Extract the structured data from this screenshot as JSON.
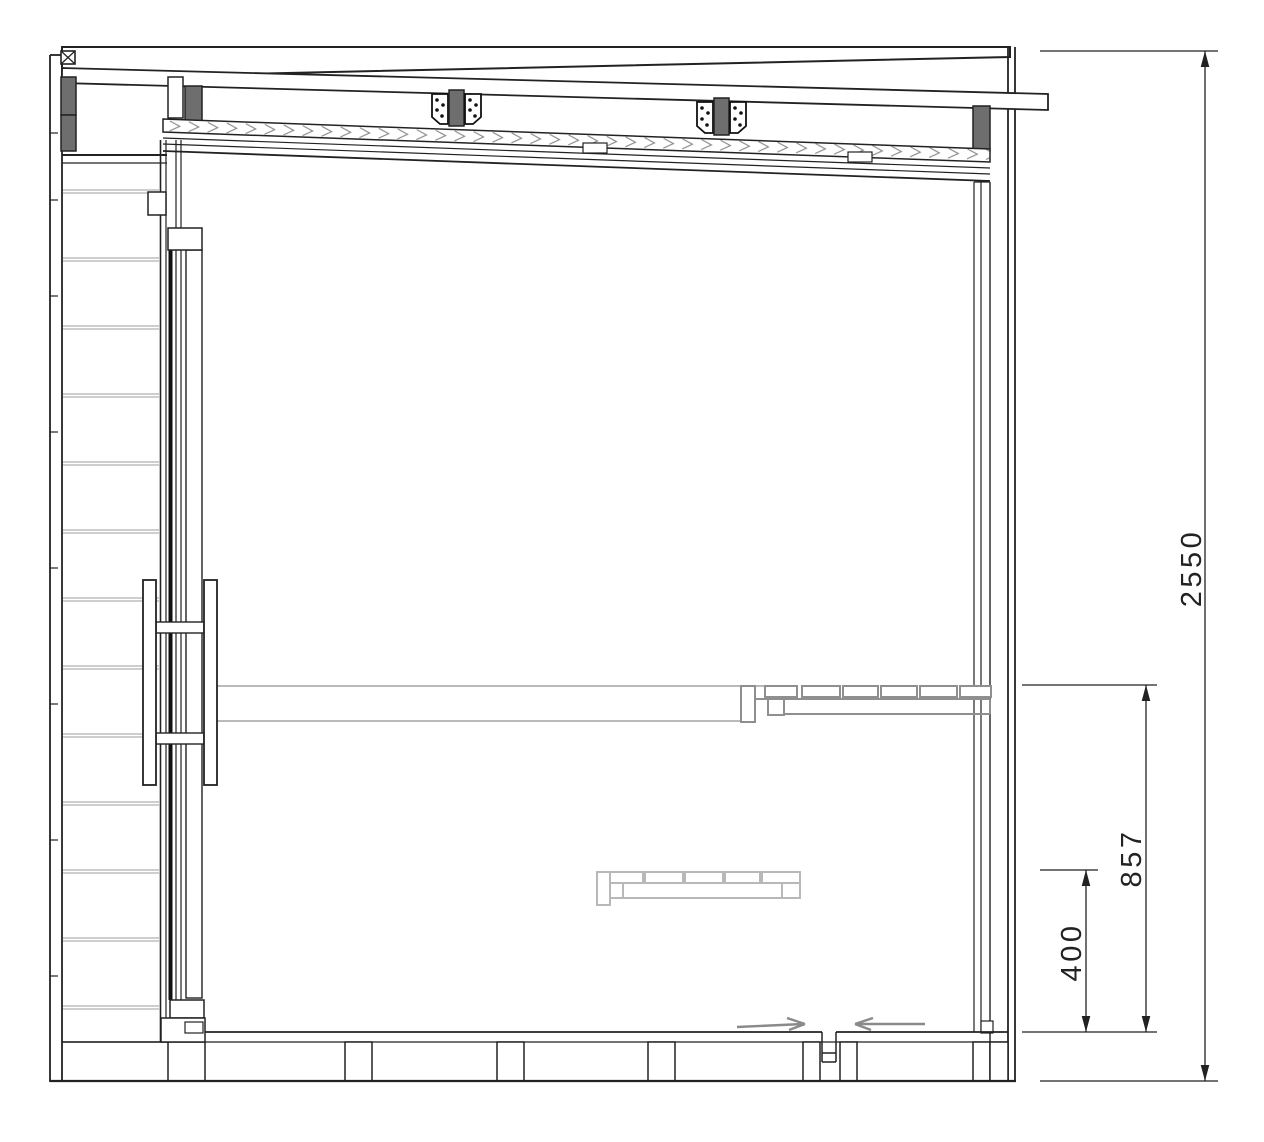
{
  "drawing": {
    "kind": "architectural-section",
    "dimensions": {
      "overall_height": "2550",
      "upper_bench_height": "857",
      "lower_bench_height": "400"
    },
    "colors": {
      "line": "#222222",
      "glass_line": "#111111",
      "dark_fill": "#6e6e6e",
      "bench_gray": "#8f8f8f",
      "hidden_gray": "#b8b8b8",
      "cladding_joint_gray": "#bdbdbd",
      "room_line_gray": "#a3a3a3",
      "arrow_gray": "#8a8a8a",
      "background": "#ffffff"
    }
  }
}
